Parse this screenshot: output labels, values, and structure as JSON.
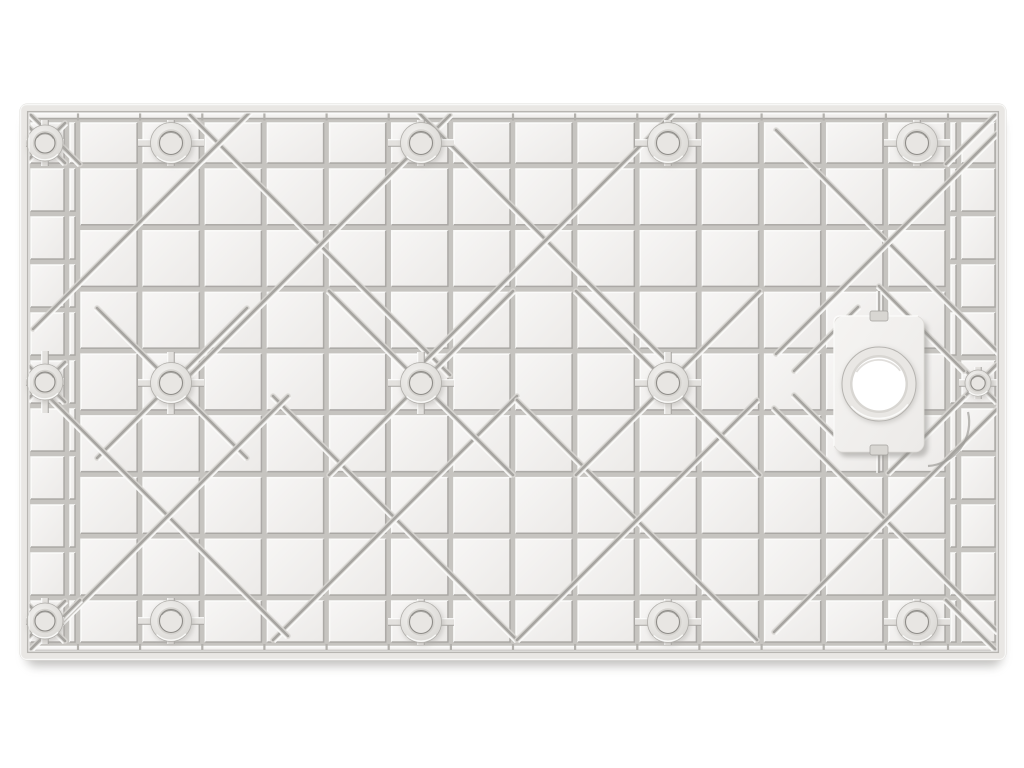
{
  "scene": {
    "alt_text": "Product photo: underside of a white molded plastic shower tray base with reinforcing rib grid, diagonal braces, round mounting bosses and an offset round drain opening on a rectangular plate",
    "background_color": "#ffffff"
  },
  "colors": {
    "bg": "#ffffff",
    "panelTop": "#e9e7e4",
    "base": "#c6c4c0",
    "cellA": "#f7f6f5",
    "cellB": "#eceae8",
    "bevelLight": "#fcfcfb",
    "bevelDark": "#a3a19d",
    "diagFace": "#d9d7d3",
    "diagDark": "#9e9c98",
    "diagLight": "#fbfbfa",
    "wallLine": "#b7b5b1",
    "wallHi": "#f8f8f7",
    "outerEdge": "#dedcd8",
    "bossFaceA": "#f4f3f1",
    "bossFaceB": "#d5d3cf",
    "bossRim": "#b0aeaa",
    "bossHole": "#e8e6e3",
    "holeRim": "#8f8d89",
    "armFill": "#e3e1de",
    "plate": "#f5f4f2",
    "ringFill": "#e9e7e4",
    "ringShadow": "#b6b4b0",
    "holeWhite": "#ffffff",
    "shadow": "#8f8d89",
    "tick": "#b3b1ad",
    "notch": "#d8d6d2"
  },
  "panel": {
    "x": 20,
    "y": 104,
    "w": 986,
    "h": 556,
    "rx": 7,
    "wall": 8
  },
  "inner": {
    "x": 28,
    "y": 112,
    "w": 970,
    "h": 540
  },
  "clip": {
    "x": 29.5,
    "y": 113.5,
    "w": 967,
    "h": 537
  },
  "grid": {
    "gap": 3,
    "col_edges": [
      78,
      140.1,
      202.3,
      264.4,
      326.6,
      388.7,
      450.9,
      513,
      575.1,
      637.3,
      699.4,
      761.6,
      823.7,
      885.9,
      948
    ],
    "row_edges": [
      166,
      227.7,
      289.4,
      351.1,
      412.9,
      474.6,
      536.3,
      598
    ],
    "top_row": [
      120,
      166
    ],
    "bottom_row": [
      598,
      645
    ],
    "margin_rows": [
      120,
      166,
      214,
      262,
      310,
      358,
      406,
      454,
      502,
      550,
      598,
      645
    ],
    "left_margin": [
      28,
      67
    ],
    "left_strip": [
      67,
      78
    ],
    "right_strip": [
      948,
      959
    ],
    "right_margin": [
      959,
      998
    ],
    "top_band": [
      112,
      120
    ],
    "bottom_band": [
      645,
      652
    ]
  },
  "bosses": [
    {
      "x": 45,
      "y": 143,
      "r": 18,
      "hr": 10,
      "ah": 19,
      "av": 23
    },
    {
      "x": 171,
      "y": 143,
      "r": 20.5,
      "hr": 11.5,
      "ah": 33,
      "av": 23
    },
    {
      "x": 421,
      "y": 143,
      "r": 20.5,
      "hr": 11.5,
      "ah": 33,
      "av": 23
    },
    {
      "x": 668,
      "y": 143,
      "r": 20.5,
      "hr": 11.5,
      "ah": 33,
      "av": 23
    },
    {
      "x": 917,
      "y": 143,
      "r": 20.5,
      "hr": 11.5,
      "ah": 33,
      "av": 23
    },
    {
      "x": 45,
      "y": 382,
      "r": 18,
      "hr": 10,
      "ah": 19,
      "av": 31
    },
    {
      "x": 171,
      "y": 383,
      "r": 20.5,
      "hr": 11.5,
      "ah": 33,
      "av": 31
    },
    {
      "x": 421,
      "y": 383,
      "r": 20.5,
      "hr": 11.5,
      "ah": 33,
      "av": 31
    },
    {
      "x": 668,
      "y": 383,
      "r": 20.5,
      "hr": 11.5,
      "ah": 33,
      "av": 31
    },
    {
      "x": 978,
      "y": 383,
      "r": 13,
      "hr": 7.2,
      "ah": 19,
      "av": 16
    },
    {
      "x": 45,
      "y": 621,
      "r": 18,
      "hr": 10,
      "ah": 19,
      "av": 23
    },
    {
      "x": 171,
      "y": 621,
      "r": 20.5,
      "hr": 11.5,
      "ah": 33,
      "av": 23
    },
    {
      "x": 421,
      "y": 622,
      "r": 20.5,
      "hr": 11.5,
      "ah": 33,
      "av": 23
    },
    {
      "x": 668,
      "y": 622,
      "r": 20.5,
      "hr": 11.5,
      "ah": 33,
      "av": 23
    },
    {
      "x": 917,
      "y": 622,
      "r": 20.5,
      "hr": 11.5,
      "ah": 33,
      "av": 23
    }
  ],
  "drain": {
    "plate": {
      "x": 834,
      "y": 316,
      "w": 90,
      "h": 136,
      "rx": 9
    },
    "notch_top": {
      "x": 870,
      "y": 311,
      "w": 18,
      "h": 10
    },
    "notch_bottom": {
      "x": 870,
      "y": 445,
      "w": 18,
      "h": 10
    },
    "cx": 879,
    "cy": 384,
    "ring_r": 37,
    "hole_r": 26.5,
    "grooves": [
      [
        879,
        291,
        879,
        315
      ],
      [
        879,
        453,
        879,
        473
      ]
    ],
    "arc": "M928,466 A44,44 0 0 0 968,412"
  },
  "diagonals": {
    "segments": [
      [
        190,
        115,
        450,
        375
      ],
      [
        450,
        115,
        190,
        375
      ],
      [
        418,
        112,
        674,
        368
      ],
      [
        674,
        112,
        418,
        368
      ],
      [
        776,
        130,
        1000,
        354
      ],
      [
        1000,
        130,
        776,
        354
      ],
      [
        273,
        396,
        517,
        640
      ],
      [
        517,
        396,
        273,
        640
      ],
      [
        517,
        400,
        757,
        640
      ],
      [
        757,
        400,
        517,
        640
      ],
      [
        774,
        408,
        998,
        632
      ],
      [
        998,
        408,
        774,
        632
      ],
      [
        329,
        291,
        513,
        475
      ],
      [
        513,
        291,
        329,
        475
      ],
      [
        576,
        291,
        760,
        475
      ],
      [
        760,
        291,
        576,
        475
      ],
      [
        97,
        308,
        247,
        458
      ],
      [
        247,
        308,
        97,
        458
      ],
      [
        48,
        396,
        288,
        636
      ],
      [
        288,
        396,
        48,
        636
      ],
      [
        25,
        123,
        65,
        163
      ],
      [
        65,
        123,
        25,
        163
      ],
      [
        25,
        362,
        65,
        402
      ],
      [
        65,
        362,
        25,
        402
      ],
      [
        25,
        601,
        65,
        641
      ],
      [
        65,
        601,
        25,
        641
      ],
      [
        959,
        364,
        997,
        402
      ],
      [
        997,
        364,
        959,
        402
      ],
      [
        250,
        112,
        33,
        329
      ],
      [
        24,
        108,
        80,
        164
      ],
      [
        1002,
        108,
        946,
        164
      ],
      [
        24,
        656,
        80,
        600
      ],
      [
        1002,
        656,
        946,
        600
      ],
      [
        879,
        286,
        964,
        371
      ],
      [
        964,
        397,
        888,
        473
      ],
      [
        858,
        307,
        794,
        371
      ],
      [
        794,
        395,
        846,
        447
      ]
    ]
  }
}
